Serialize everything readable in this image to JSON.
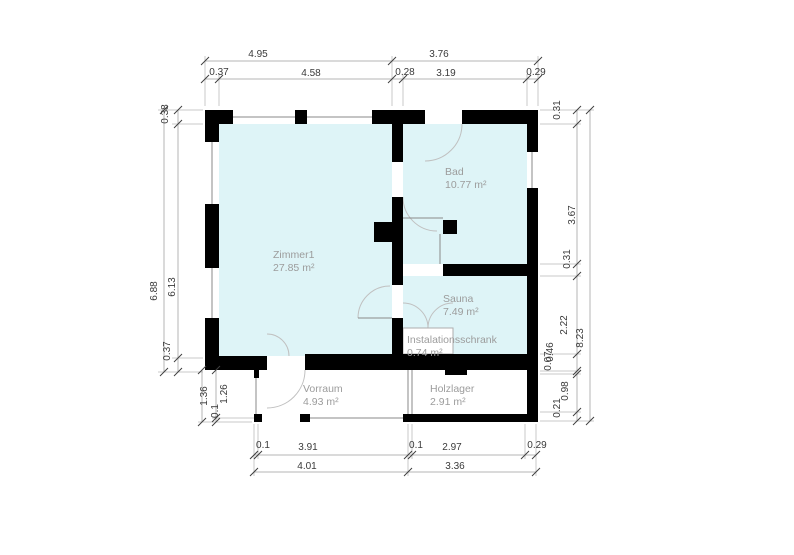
{
  "page": {
    "background": "#ffffff",
    "width": 794,
    "height": 555
  },
  "colors": {
    "room_fill": "#def4f7",
    "wall": "#000000",
    "window_line": "#8a8a8a",
    "arc": "#c0c0c0",
    "ext_line": "#c9c9c9",
    "dim_line": "#b5b5b5",
    "tick": "#3f3f3f",
    "dim_text": "#3a3a3a",
    "room_text": "#9c9c9c",
    "white_box_border": "#adadad"
  },
  "rooms": [
    {
      "id": "zimmer1",
      "name": "Zimmer1",
      "area": "27.85 m²",
      "x": 219,
      "y": 124,
      "w": 173,
      "h": 232,
      "lx": 273,
      "ly": 258,
      "kind": "fill"
    },
    {
      "id": "bad",
      "name": "Bad",
      "area": "10.77 m²",
      "x": 403,
      "y": 124,
      "w": 124,
      "h": 140,
      "lx": 445,
      "ly": 175,
      "kind": "fill"
    },
    {
      "id": "sauna",
      "name": "Sauna",
      "area": "7.49 m²",
      "x": 403,
      "y": 276,
      "w": 124,
      "h": 78,
      "lx": 443,
      "ly": 302,
      "kind": "fill"
    },
    {
      "id": "instalationsschrank",
      "name": "Instalationsschrank",
      "area": "0.74 m²",
      "x": 403,
      "y": 328,
      "w": 50,
      "h": 26,
      "lx": 407,
      "ly": 343,
      "kind": "white"
    },
    {
      "id": "vorraum",
      "name": "Vorraum",
      "area": "4.93 m²",
      "x": 258,
      "y": 370,
      "w": 150,
      "h": 48,
      "lx": 303,
      "ly": 392,
      "kind": "open"
    },
    {
      "id": "holzlager",
      "name": "Holzlager",
      "area": "2.91 m²",
      "x": 412,
      "y": 370,
      "w": 115,
      "h": 44,
      "lx": 430,
      "ly": 392,
      "kind": "open"
    }
  ],
  "walls": [
    [
      205,
      110,
      28,
      14
    ],
    [
      205,
      124,
      14,
      18
    ],
    [
      295,
      110,
      12,
      14
    ],
    [
      372,
      110,
      53,
      14
    ],
    [
      462,
      110,
      76,
      14
    ],
    [
      205,
      204,
      14,
      64
    ],
    [
      205,
      318,
      14,
      38
    ],
    [
      205,
      356,
      62,
      14
    ],
    [
      305,
      354,
      233,
      16
    ],
    [
      527,
      110,
      11,
      42
    ],
    [
      527,
      188,
      11,
      76
    ],
    [
      527,
      264,
      11,
      158
    ],
    [
      392,
      124,
      11,
      38
    ],
    [
      392,
      197,
      11,
      88
    ],
    [
      392,
      318,
      11,
      38
    ],
    [
      374,
      222,
      18,
      20
    ],
    [
      443,
      220,
      14,
      14
    ],
    [
      443,
      264,
      95,
      12
    ],
    [
      254,
      370,
      5,
      8
    ],
    [
      254,
      414,
      8,
      8
    ],
    [
      300,
      414,
      10,
      8
    ],
    [
      403,
      414,
      135,
      8
    ],
    [
      445,
      370,
      22,
      5
    ]
  ],
  "window_lines": [
    [
      233,
      117,
      295,
      117
    ],
    [
      307,
      117,
      372,
      117
    ],
    [
      212,
      142,
      212,
      204
    ],
    [
      212,
      268,
      212,
      318
    ],
    [
      532,
      152,
      532,
      188
    ],
    [
      532,
      248,
      532,
      264
    ],
    [
      256,
      378,
      256,
      414
    ],
    [
      305,
      418,
      408,
      418
    ],
    [
      408,
      370,
      408,
      414
    ],
    [
      412,
      370,
      412,
      414
    ],
    [
      440,
      234,
      440,
      264
    ],
    [
      403,
      218,
      443,
      218
    ],
    [
      358,
      318,
      392,
      318
    ]
  ],
  "door_arcs": [
    "M462 124 A37 37 0 0 1 425 161",
    "M403 197 A34 34 0 0 0 437 231",
    "M358 318 A32 32 0 0 1 390 286",
    "M403 303 A25 25 0 0 1 428 328",
    "M453 303 A25 25 0 0 0 428 328",
    "M305 370 A38 38 0 0 1 267 408",
    "M289 356 A22 22 0 0 0 267 334"
  ],
  "ext_lines": [
    [
      205,
      56,
      205,
      106
    ],
    [
      392,
      56,
      392,
      106
    ],
    [
      538,
      56,
      538,
      106
    ],
    [
      219,
      74,
      219,
      106
    ],
    [
      403,
      74,
      403,
      106
    ],
    [
      527,
      74,
      527,
      106
    ],
    [
      158,
      110,
      203,
      110
    ],
    [
      172,
      124,
      203,
      124
    ],
    [
      172,
      358,
      203,
      358
    ],
    [
      158,
      372,
      203,
      372
    ],
    [
      540,
      110,
      594,
      110
    ],
    [
      540,
      124,
      581,
      124
    ],
    [
      540,
      264,
      581,
      264
    ],
    [
      540,
      276,
      581,
      276
    ],
    [
      540,
      354,
      581,
      354
    ],
    [
      540,
      371,
      581,
      371
    ],
    [
      540,
      374,
      581,
      374
    ],
    [
      540,
      412,
      581,
      412
    ],
    [
      540,
      421,
      594,
      421
    ],
    [
      254,
      424,
      254,
      476
    ],
    [
      258,
      424,
      258,
      459
    ],
    [
      408,
      424,
      408,
      476
    ],
    [
      412,
      424,
      412,
      459
    ],
    [
      525,
      424,
      525,
      459
    ],
    [
      536,
      424,
      536,
      476
    ],
    [
      212,
      418,
      254,
      418
    ],
    [
      198,
      422,
      252,
      422
    ]
  ],
  "dim_lines": [
    [
      205,
      61,
      538,
      61
    ],
    [
      205,
      79,
      538,
      79
    ],
    [
      164,
      110,
      164,
      372
    ],
    [
      178,
      110,
      178,
      372
    ],
    [
      202,
      370,
      202,
      422
    ],
    [
      216,
      370,
      216,
      422
    ],
    [
      577,
      110,
      577,
      421
    ],
    [
      590,
      110,
      590,
      421
    ],
    [
      254,
      455,
      536,
      455
    ],
    [
      254,
      472,
      536,
      472
    ]
  ],
  "ticks": [
    [
      205,
      61
    ],
    [
      392,
      61
    ],
    [
      538,
      61
    ],
    [
      205,
      79
    ],
    [
      219,
      79
    ],
    [
      392,
      79
    ],
    [
      403,
      79
    ],
    [
      527,
      79
    ],
    [
      538,
      79
    ],
    [
      164,
      110
    ],
    [
      164,
      372
    ],
    [
      178,
      110
    ],
    [
      178,
      124
    ],
    [
      178,
      358
    ],
    [
      178,
      372
    ],
    [
      202,
      370
    ],
    [
      202,
      422
    ],
    [
      216,
      370
    ],
    [
      216,
      418
    ],
    [
      216,
      422
    ],
    [
      577,
      110
    ],
    [
      577,
      124
    ],
    [
      577,
      264
    ],
    [
      577,
      276
    ],
    [
      577,
      354
    ],
    [
      577,
      371
    ],
    [
      577,
      374
    ],
    [
      577,
      412
    ],
    [
      577,
      421
    ],
    [
      590,
      110
    ],
    [
      590,
      421
    ],
    [
      254,
      455
    ],
    [
      258,
      455
    ],
    [
      408,
      455
    ],
    [
      412,
      455
    ],
    [
      525,
      455
    ],
    [
      536,
      455
    ],
    [
      254,
      472
    ],
    [
      408,
      472
    ],
    [
      536,
      472
    ]
  ],
  "dim_labels": [
    {
      "t": "4.95",
      "x": 258,
      "y": 57,
      "r": 0
    },
    {
      "t": "3.76",
      "x": 439,
      "y": 57,
      "r": 0
    },
    {
      "t": "0.37",
      "x": 219,
      "y": 75,
      "r": 0
    },
    {
      "t": "4.58",
      "x": 311,
      "y": 76,
      "r": 0
    },
    {
      "t": "0.28",
      "x": 405,
      "y": 75,
      "r": 0
    },
    {
      "t": "3.19",
      "x": 446,
      "y": 76,
      "r": 0
    },
    {
      "t": "0.29",
      "x": 536,
      "y": 75,
      "r": 0
    },
    {
      "t": "0.38",
      "x": 168,
      "y": 114,
      "r": -90
    },
    {
      "t": "6.88",
      "x": 157,
      "y": 291,
      "r": -90
    },
    {
      "t": "6.13",
      "x": 175,
      "y": 287,
      "r": -90
    },
    {
      "t": "0.37",
      "x": 170,
      "y": 351,
      "r": -90
    },
    {
      "t": "1.36",
      "x": 207,
      "y": 396,
      "r": -90
    },
    {
      "t": "0.1",
      "x": 218,
      "y": 411,
      "r": -90
    },
    {
      "t": "1.26",
      "x": 227,
      "y": 394,
      "r": -90
    },
    {
      "t": "0.31",
      "x": 560,
      "y": 110,
      "r": -90
    },
    {
      "t": "3.67",
      "x": 575,
      "y": 215,
      "r": -90
    },
    {
      "t": "0.31",
      "x": 570,
      "y": 259,
      "r": -90
    },
    {
      "t": "2.22",
      "x": 567,
      "y": 325,
      "r": -90
    },
    {
      "t": "0.46",
      "x": 553,
      "y": 352,
      "r": -90
    },
    {
      "t": "0.07",
      "x": 551,
      "y": 361,
      "r": -90
    },
    {
      "t": "0.98",
      "x": 568,
      "y": 391,
      "r": -90
    },
    {
      "t": "0.21",
      "x": 560,
      "y": 408,
      "r": -90
    },
    {
      "t": "8.23",
      "x": 583,
      "y": 338,
      "r": -90
    },
    {
      "t": "0.1",
      "x": 263,
      "y": 448,
      "r": 0
    },
    {
      "t": "3.91",
      "x": 308,
      "y": 450,
      "r": 0
    },
    {
      "t": "0.1",
      "x": 416,
      "y": 448,
      "r": 0
    },
    {
      "t": "2.97",
      "x": 452,
      "y": 450,
      "r": 0
    },
    {
      "t": "0.29",
      "x": 537,
      "y": 448,
      "r": 0
    },
    {
      "t": "4.01",
      "x": 307,
      "y": 469,
      "r": 0
    },
    {
      "t": "3.36",
      "x": 455,
      "y": 469,
      "r": 0
    }
  ]
}
